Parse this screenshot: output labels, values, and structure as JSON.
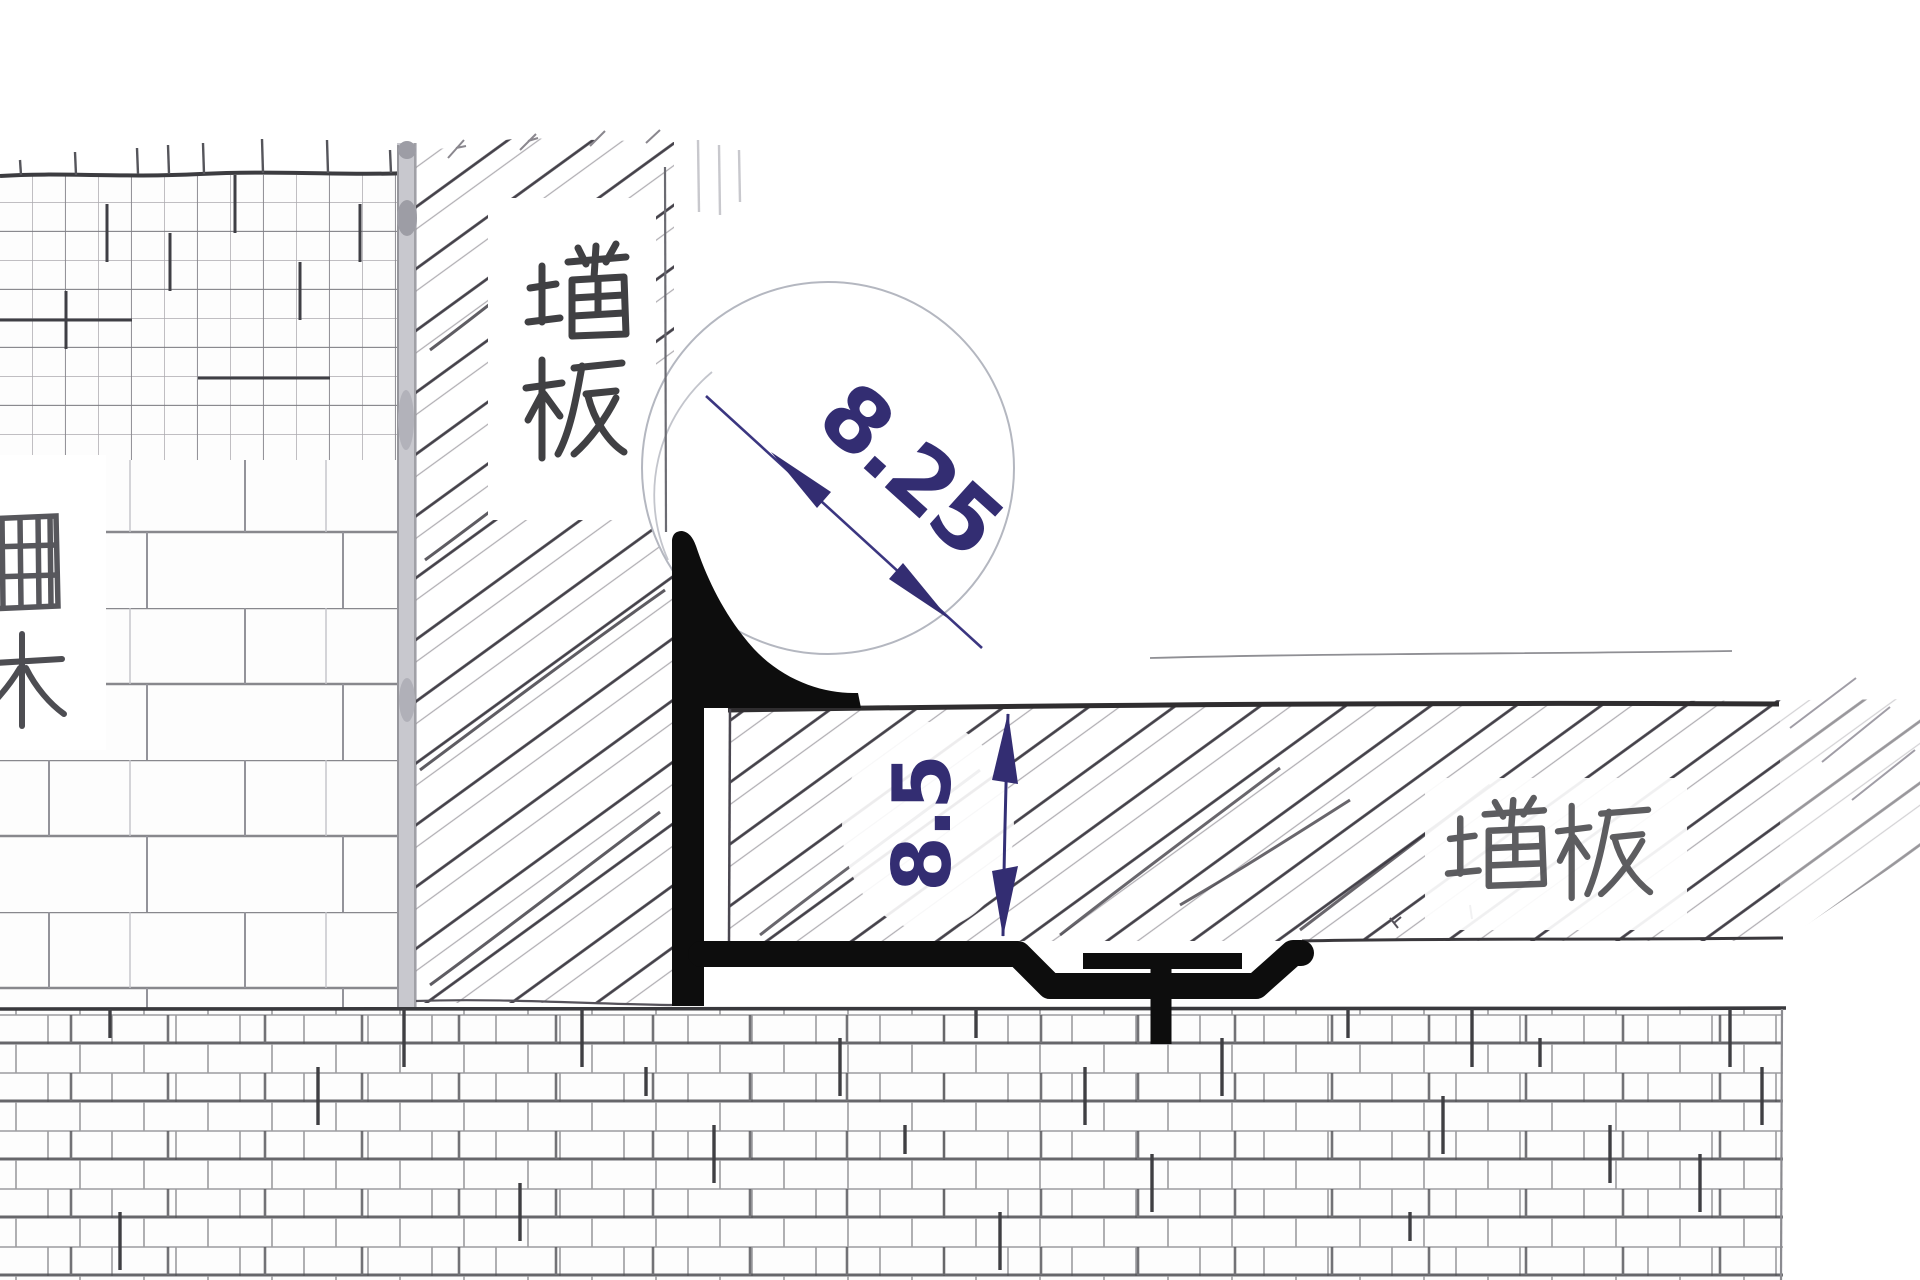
{
  "drawing": {
    "kind": "hand-drawn tile trim corner detail",
    "dimensions": {
      "top_value": "8.25",
      "side_value": "8.5"
    },
    "labels": {
      "vertical_panel": "墙板",
      "horizontal_panel": "墙板",
      "left_edge_partial": "面木"
    },
    "colors": {
      "ink_blue": "#39327c",
      "profile_black": "#0d0d0d",
      "hatch_dark": "#45424a",
      "grid_thin": "#a9a9ad",
      "grid_dark": "#4d4d51",
      "paper": "#ffffff"
    }
  }
}
